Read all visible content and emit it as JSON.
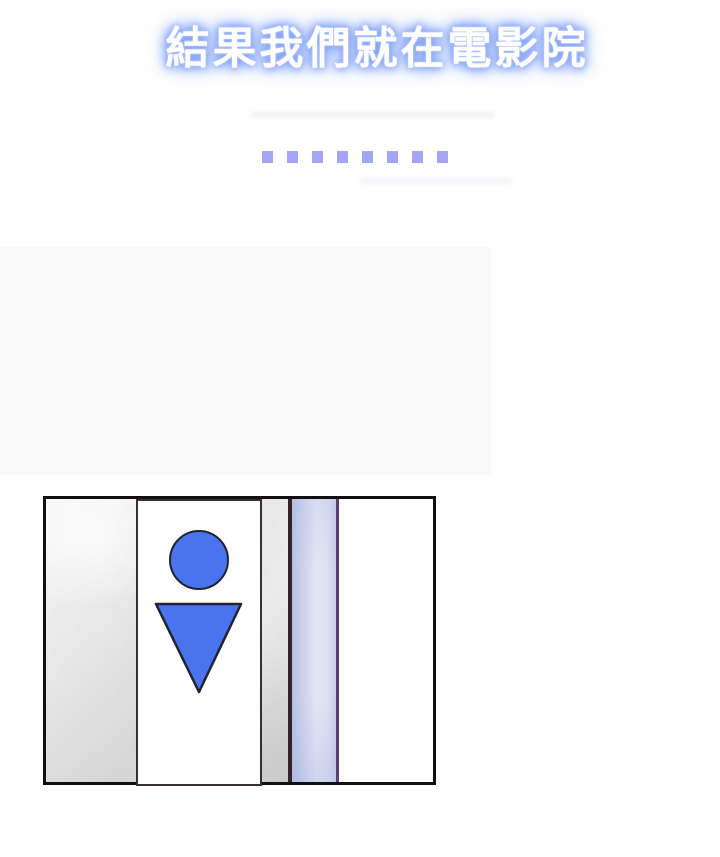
{
  "caption": {
    "text": "結果我們就在電影院"
  },
  "ellipsis": {
    "count": 8
  },
  "panel": {
    "sign": {
      "icon": "male-restroom-icon"
    }
  },
  "colors": {
    "title_text": "#ffffff",
    "title_glow": "#7d9ff8",
    "dot": "#a5a5f6",
    "icon_blue": "#4a74ee",
    "icon_stroke": "#1f2430",
    "panel_border": "#101010",
    "wall_light": "#f1f1f1",
    "wall_dark": "#d6d6d6",
    "strip_light": "#e3e7f4",
    "strip_dark": "#b9c1e2",
    "strip_line_left": "#34242a",
    "strip_line_right": "#56446e",
    "sign_border": "#3a2e2e",
    "faded_block": "#fafafa"
  }
}
